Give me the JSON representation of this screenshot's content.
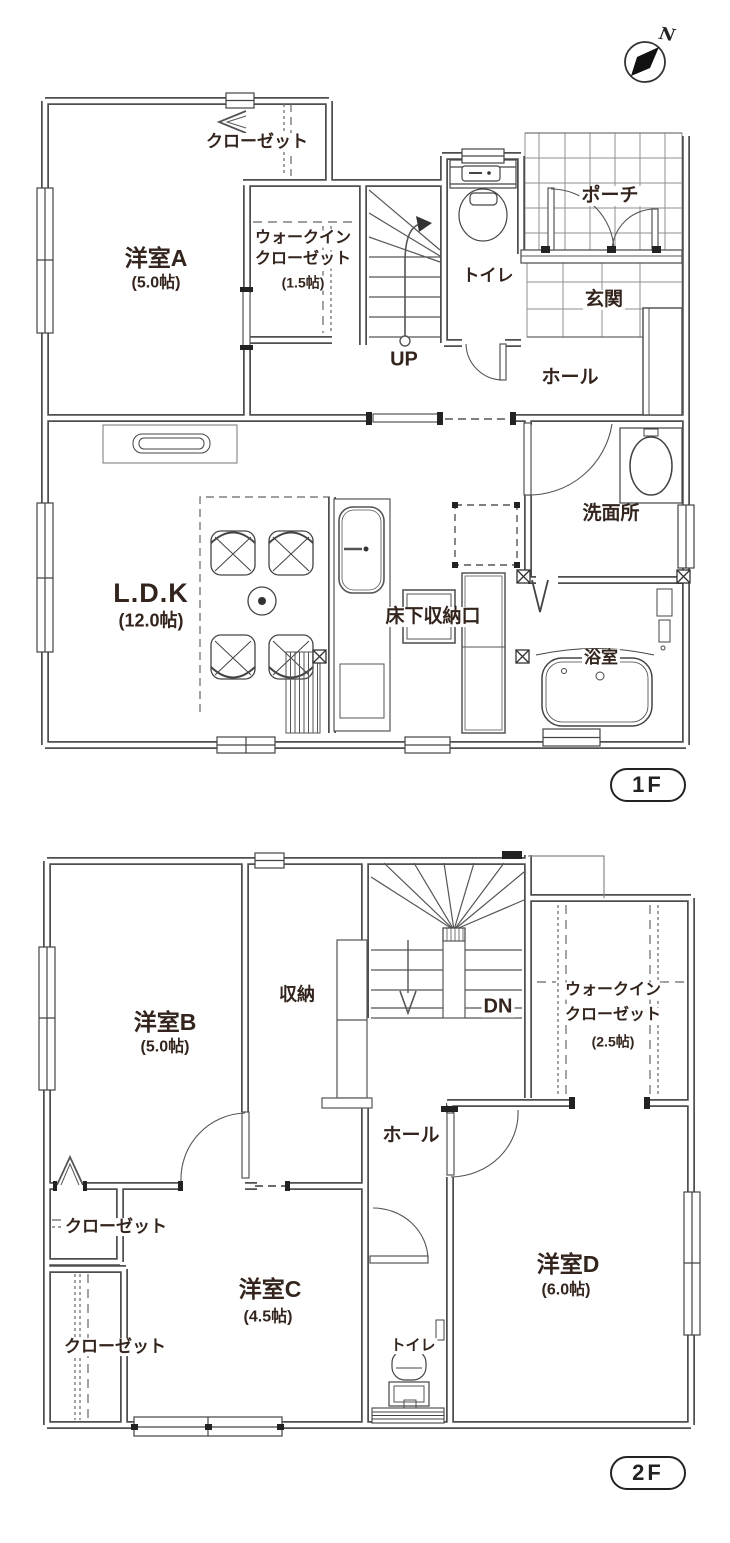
{
  "compass": {
    "label": "N"
  },
  "floor1": {
    "badge": "1F",
    "rooms": {
      "closet": {
        "name": "クローゼット"
      },
      "yoshitsu_a": {
        "name": "洋室A",
        "size": "(5.0帖)"
      },
      "wic": {
        "line1": "ウォークイン",
        "line2": "クローゼット",
        "size": "(1.5帖)"
      },
      "stairs": {
        "label": "UP"
      },
      "toilet": {
        "name": "トイレ"
      },
      "porch": {
        "name": "ポーチ"
      },
      "entrance": {
        "name": "玄関"
      },
      "hall": {
        "name": "ホール"
      },
      "ldk": {
        "name": "L.D.K",
        "size": "(12.0帖)"
      },
      "underfloor": {
        "name": "床下収納口"
      },
      "washroom": {
        "name": "洗面所"
      },
      "bathroom": {
        "name": "浴室"
      }
    }
  },
  "floor2": {
    "badge": "2F",
    "rooms": {
      "yoshitsu_b": {
        "name": "洋室B",
        "size": "(5.0帖)"
      },
      "storage": {
        "name": "収納"
      },
      "stairs": {
        "label": "DN"
      },
      "wic": {
        "line1": "ウォークイン",
        "line2": "クローゼット",
        "size": "(2.5帖)"
      },
      "hall": {
        "name": "ホール"
      },
      "closet1": {
        "name": "クローゼット"
      },
      "closet2": {
        "name": "クローゼット"
      },
      "yoshitsu_c": {
        "name": "洋室C",
        "size": "(4.5帖)"
      },
      "toilet": {
        "name": "トイレ"
      },
      "yoshitsu_d": {
        "name": "洋室D",
        "size": "(6.0帖)"
      }
    }
  }
}
